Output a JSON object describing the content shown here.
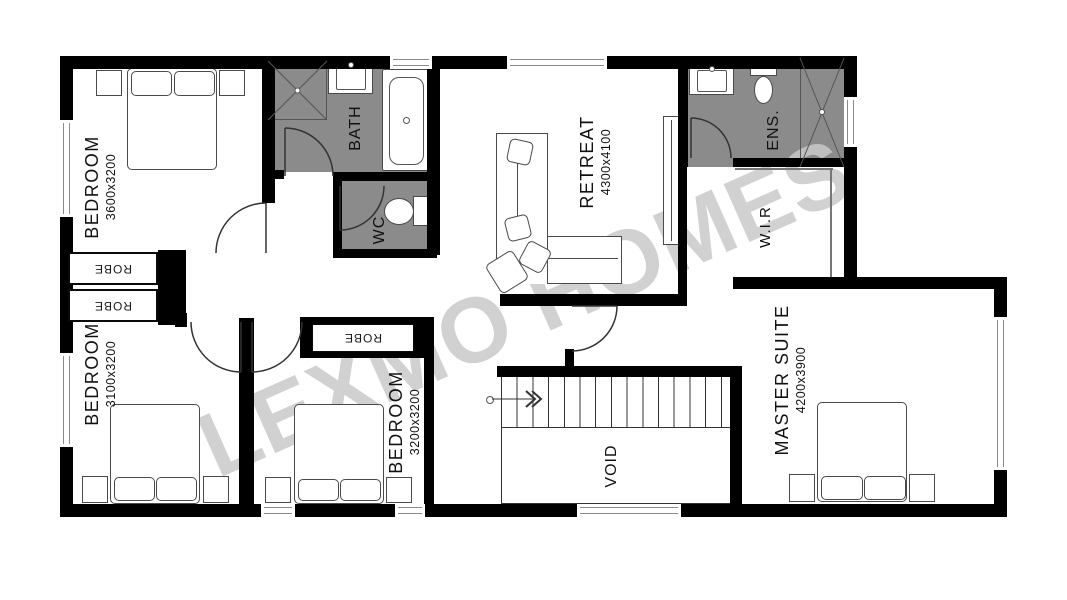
{
  "plan": {
    "watermark": "LEXMO HOMES",
    "rooms": {
      "bedroom_top_left": {
        "label": "BEDROOM",
        "dimensions": "3600x3200"
      },
      "bedroom_bottom_left": {
        "label": "BEDROOM",
        "dimensions": "3100x3200"
      },
      "bedroom_bottom_middle": {
        "label": "BEDROOM",
        "dimensions": "3200x3200"
      },
      "retreat": {
        "label": "RETREAT",
        "dimensions": "4300x4100"
      },
      "master_suite": {
        "label": "MASTER SUITE",
        "dimensions": "4200x3900"
      },
      "bath": {
        "label": "BATH"
      },
      "wc": {
        "label": "WC"
      },
      "ensuite": {
        "label": "ENS."
      },
      "walk_in_robe": {
        "label": "W.I.R"
      },
      "void": {
        "label": "VOID"
      },
      "robe_1": {
        "label": "ROBE"
      },
      "robe_2": {
        "label": "ROBE"
      },
      "robe_3": {
        "label": "ROBE"
      }
    },
    "colors": {
      "wall": "#000000",
      "wet_area_floor": "#8b8b8b",
      "watermark": "#c9c9c9",
      "outline": "#444444"
    }
  }
}
